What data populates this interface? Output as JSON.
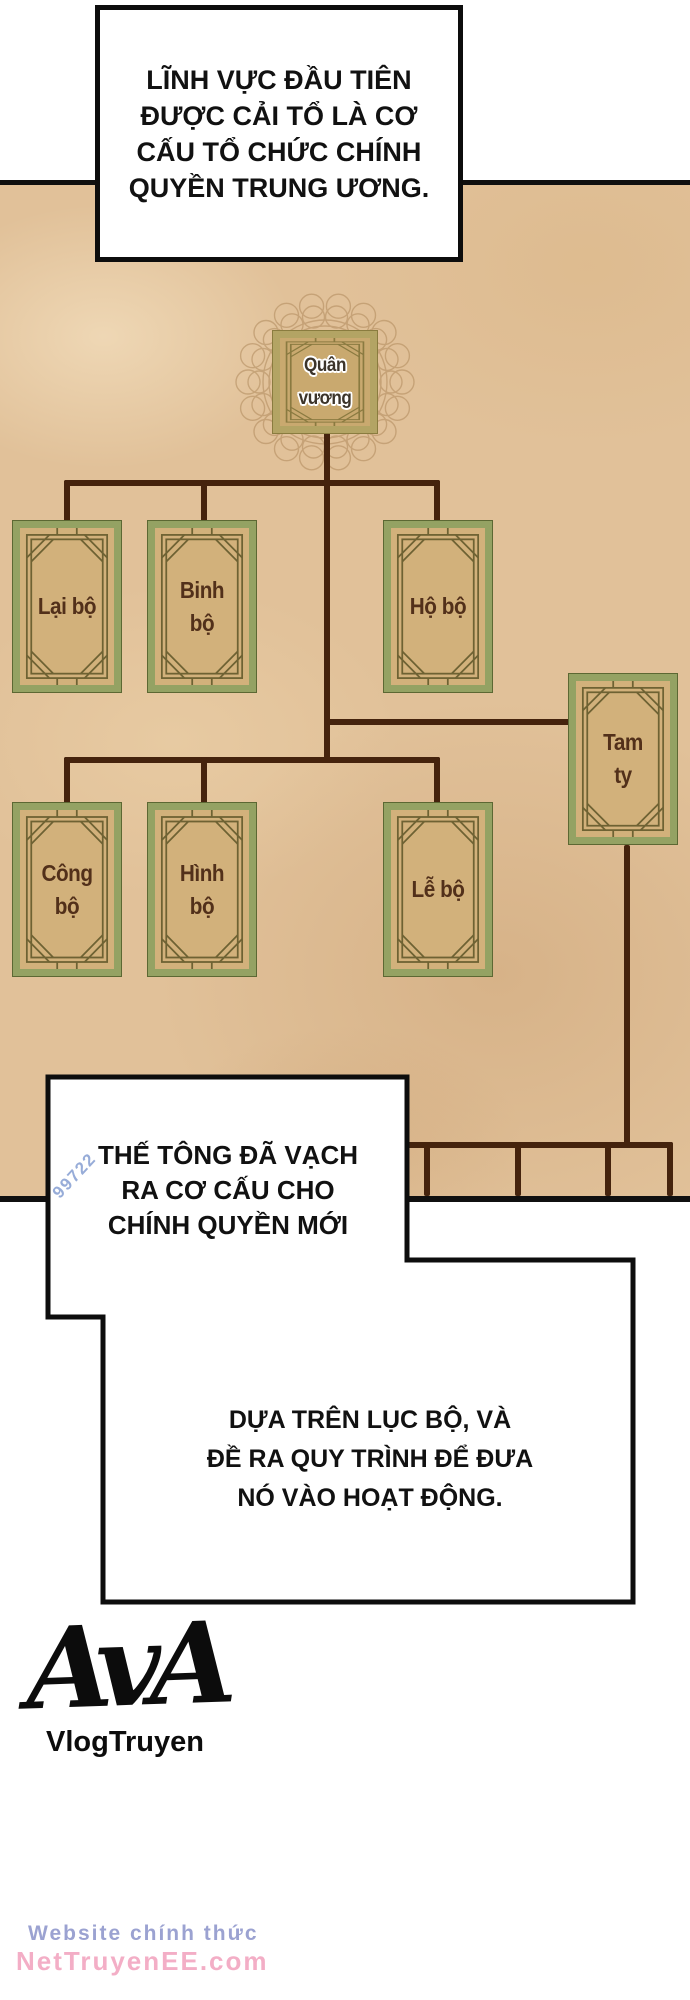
{
  "speech": {
    "bubble1": {
      "lines": [
        "LĨNH VỰC ĐẦU TIÊN",
        "ĐƯỢC CẢI TỔ LÀ CƠ",
        "CẤU TỔ CHỨC CHÍNH",
        "QUYỀN TRUNG ƯƠNG."
      ]
    },
    "bubble2": {
      "lines": [
        "THẾ TÔNG ĐÃ VẠCH",
        "RA CƠ CẤU CHO",
        "CHÍNH QUYỀN MỚI"
      ]
    },
    "bubble3": {
      "lines": [
        "DỰA TRÊN LỤC BỘ, VÀ",
        "ĐỀ RA QUY TRÌNH ĐỂ ĐƯA",
        "NÓ VÀO HOẠT ĐỘNG."
      ]
    }
  },
  "org_chart": {
    "type": "org-tree",
    "root": "Quân vương",
    "nodes": [
      {
        "id": "quan-vuong",
        "label": "Quân vương",
        "parent": null
      },
      {
        "id": "lai-bo",
        "label": "Lại bộ",
        "parent": "quan-vuong"
      },
      {
        "id": "binh-bo",
        "label": "Binh\nbộ",
        "parent": "quan-vuong"
      },
      {
        "id": "ho-bo",
        "label": "Hộ bộ",
        "parent": "quan-vuong"
      },
      {
        "id": "tam-ty",
        "label": "Tam\nty",
        "parent": "quan-vuong"
      },
      {
        "id": "cong-bo",
        "label": "Công\nbộ",
        "parent": "quan-vuong"
      },
      {
        "id": "hinh-bo",
        "label": "Hình\nbộ",
        "parent": "quan-vuong"
      },
      {
        "id": "le-bo",
        "label": "Lễ bộ",
        "parent": "quan-vuong"
      }
    ],
    "tam_ty_unlabeled_sub_branches": 4
  },
  "branding": {
    "logo_text": "AvA",
    "logo_subtitle": "VlogTruyen"
  },
  "watermarks": {
    "corner": "99722",
    "line1": "Website chính thức",
    "line2": "NetTruyenEE.com"
  },
  "colors": {
    "panel_bg": "#e1c199",
    "connector": "#45230d",
    "node_border": "#94a263",
    "node_fill": "#d2b17b",
    "king_border": "#b3a464",
    "king_fill": "#c9a96f",
    "label_text": "#52301a",
    "watermark_corner": "#8ca4d4",
    "watermark_site": "#8a92c9",
    "watermark_domain": "#f2a6c0"
  }
}
